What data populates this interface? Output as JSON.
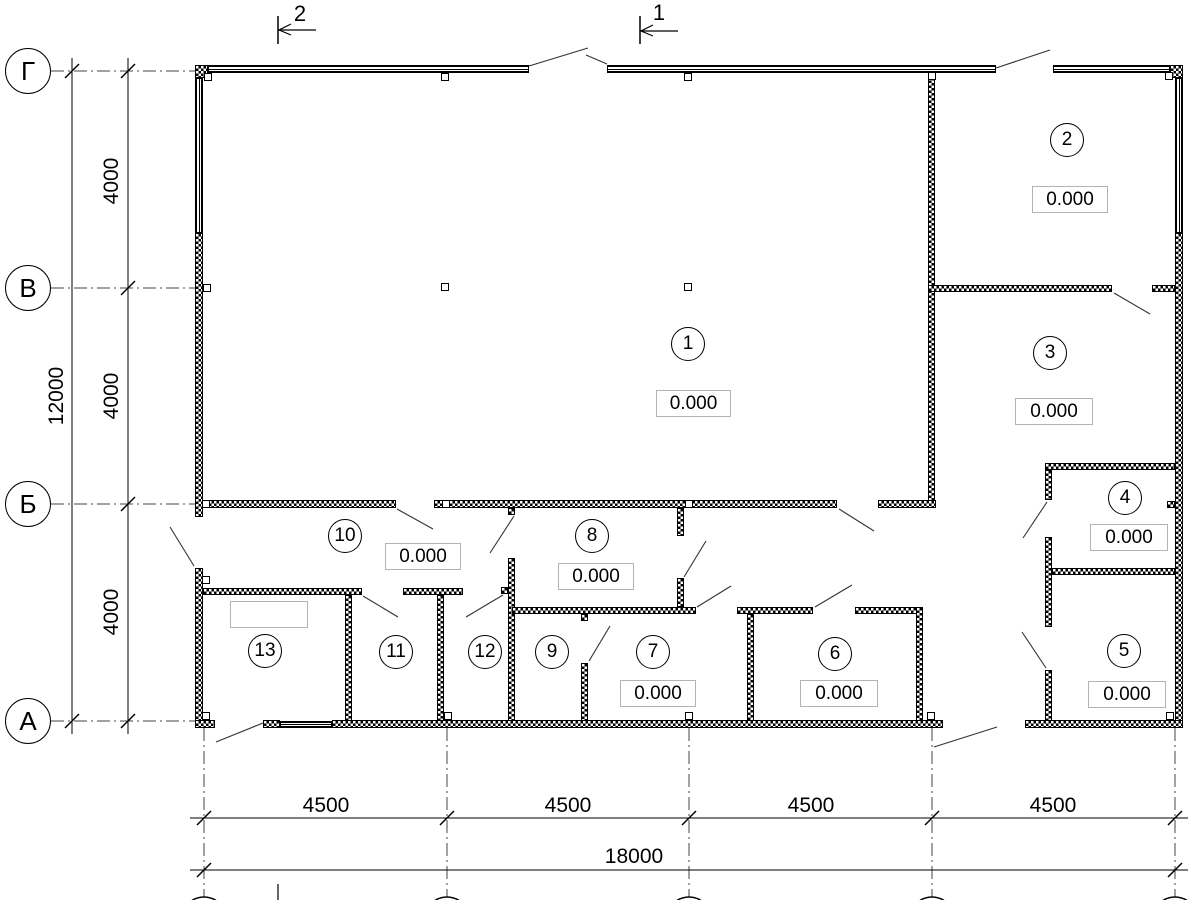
{
  "drawing": {
    "kind": "architectural floor plan",
    "elevation_value": "0.000"
  },
  "axes": {
    "rows": [
      {
        "label": "Г"
      },
      {
        "label": "В"
      },
      {
        "label": "Б"
      },
      {
        "label": "А"
      }
    ],
    "bottom_circle_count": 5
  },
  "sections": [
    {
      "label": "2"
    },
    {
      "label": "1"
    }
  ],
  "dimensions": {
    "vertical_segments": [
      "4000",
      "4000",
      "4000"
    ],
    "vertical_total": "12000",
    "horizontal_segments": [
      "4500",
      "4500",
      "4500",
      "4500"
    ],
    "horizontal_total": "18000"
  },
  "rooms": [
    {
      "number": "1",
      "elevation": "0.000"
    },
    {
      "number": "2",
      "elevation": "0.000"
    },
    {
      "number": "3",
      "elevation": "0.000"
    },
    {
      "number": "4",
      "elevation": "0.000"
    },
    {
      "number": "5",
      "elevation": "0.000"
    },
    {
      "number": "6",
      "elevation": "0.000"
    },
    {
      "number": "7",
      "elevation": "0.000"
    },
    {
      "number": "8",
      "elevation": "0.000"
    },
    {
      "number": "9"
    },
    {
      "number": "10",
      "elevation": "0.000"
    },
    {
      "number": "11"
    },
    {
      "number": "12"
    },
    {
      "number": "13"
    }
  ],
  "colors": {
    "line": "#000000",
    "background": "#ffffff",
    "elevation_box_border": "#b3b3b3"
  }
}
